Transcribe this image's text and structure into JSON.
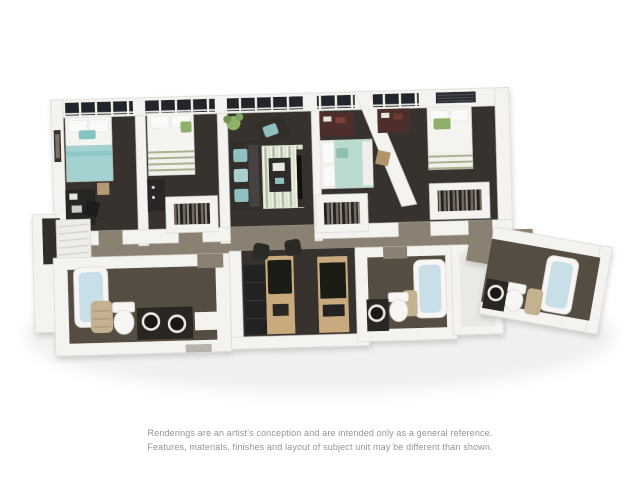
{
  "disclaimer": {
    "line1": "Renderings are an artist's conception and are intended only as a general reference.",
    "line2": "Features, materials, finishes and layout of subject unit may be different than shown."
  },
  "colors": {
    "background": "#ffffff",
    "wall": "#f4f3f0",
    "wall_edge": "#d9d6d0",
    "floor_dark": "#37332e",
    "floor_taupe": "#8b8173",
    "floor_bath": "#564d42",
    "floor_light": "#ebe9e4",
    "window_glass": "#23272c",
    "bed_white": "#f5f4f1",
    "bed_teal": "#a4d2d1",
    "bed_mint": "#badcd0",
    "accent_green": "#8fb069",
    "sage_stripe": "#a9b18d",
    "wood_maroon": "#4e2f2a",
    "furniture_dark": "#332f2c",
    "appliance_black": "#1c1a19",
    "cabinet_tan": "#c8aa7e",
    "towel_tan": "#c3b190",
    "tub_blue": "#c8dfe7",
    "fixture_white": "#f7f6f4",
    "rug_light": "#edf0e6",
    "rug_green": "#b3bfa1",
    "text_gray": "#949494",
    "shadow": "#d8d5d0"
  }
}
